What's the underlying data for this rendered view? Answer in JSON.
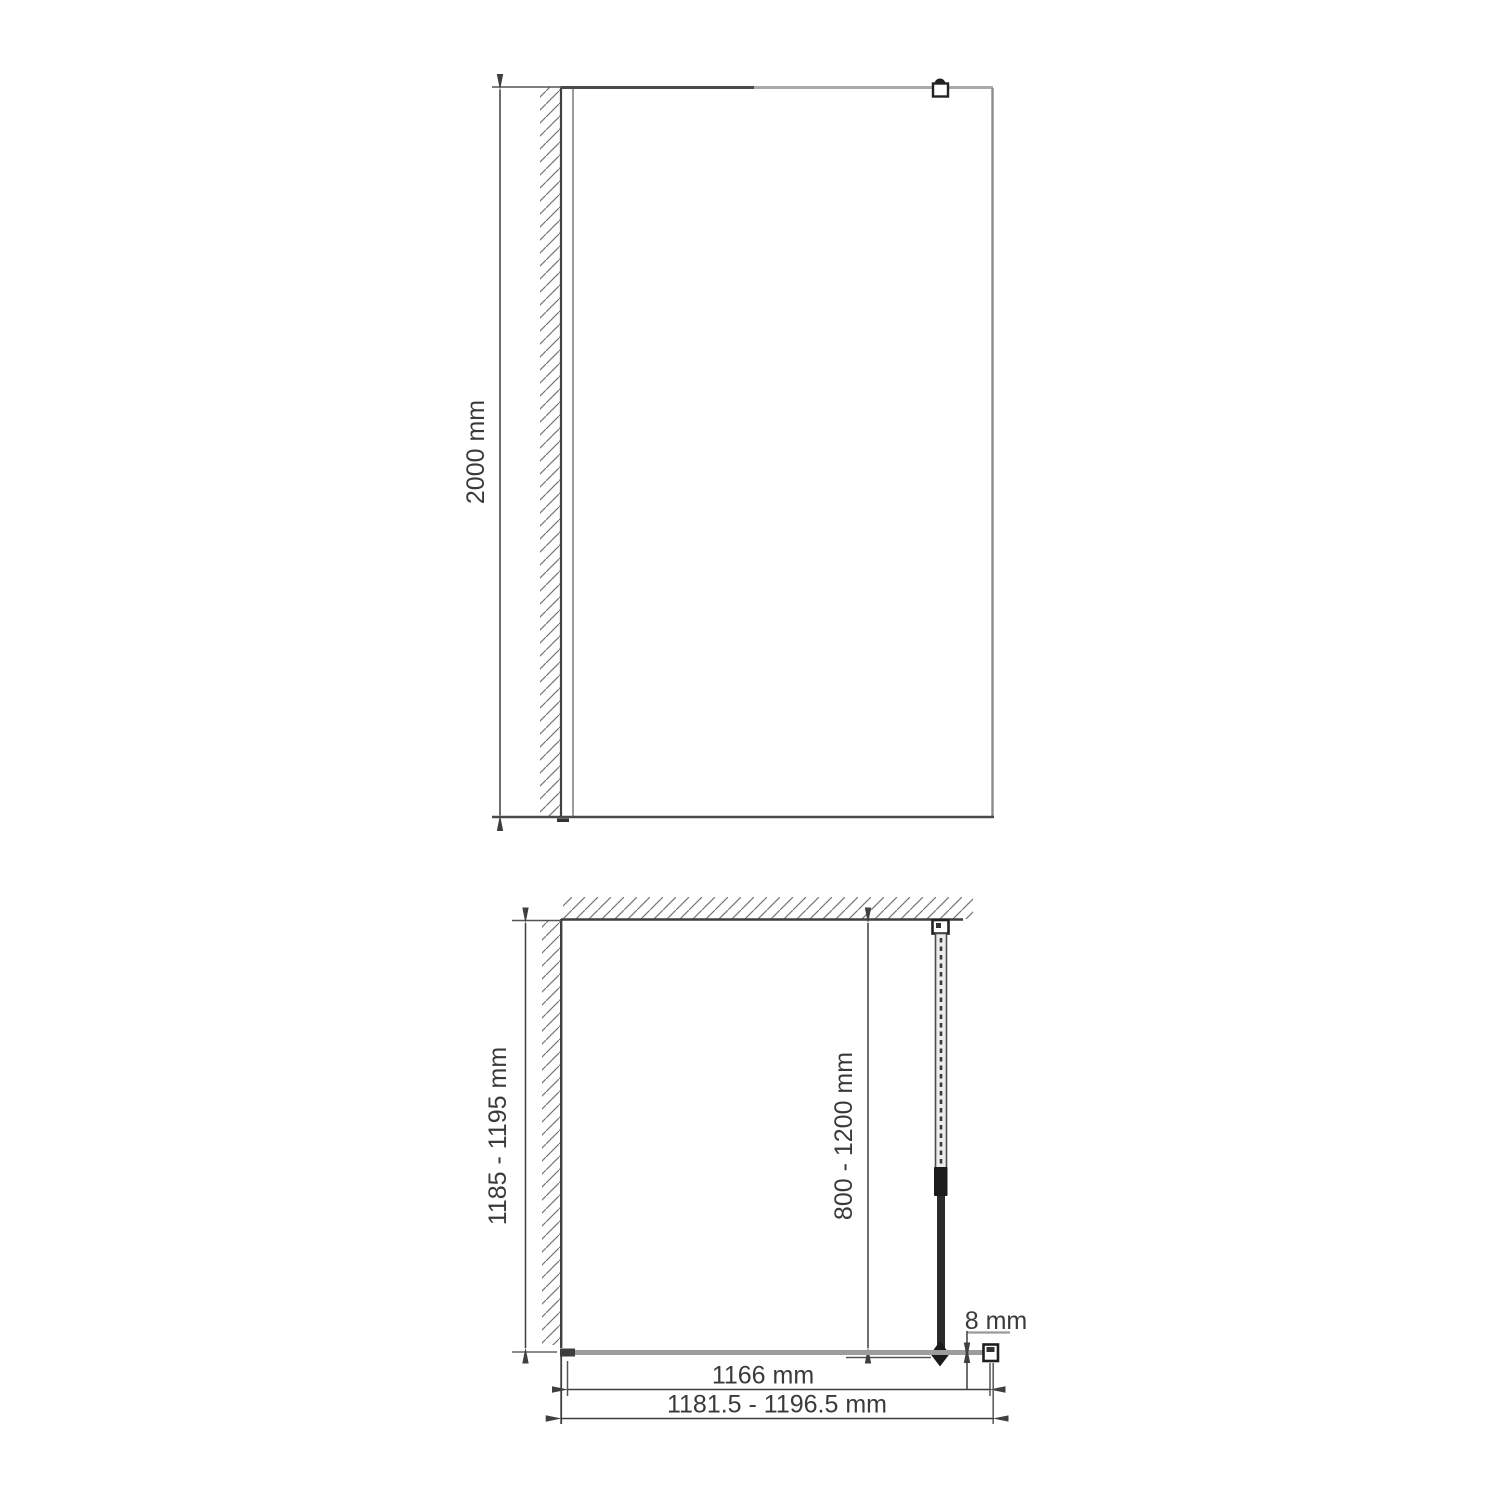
{
  "front_view": {
    "height_dim": "2000 mm",
    "wall_bracket_icon": "wall-mount-bracket"
  },
  "plan_view": {
    "wall_depth_dim": "1185 - 1195 mm",
    "support_bar_dim": "800 - 1200 mm",
    "glass_thickness_dim": "8 mm",
    "glass_width_dim": "1166 mm",
    "overall_width_dim": "1181.5 - 1196.5 mm"
  },
  "colors": {
    "line_dark": "#3f3f3f",
    "line_light": "#a9a9a9",
    "glass_gray": "#9c9c9c",
    "hatch_gray": "#757575",
    "text": "#3a3a3a"
  }
}
